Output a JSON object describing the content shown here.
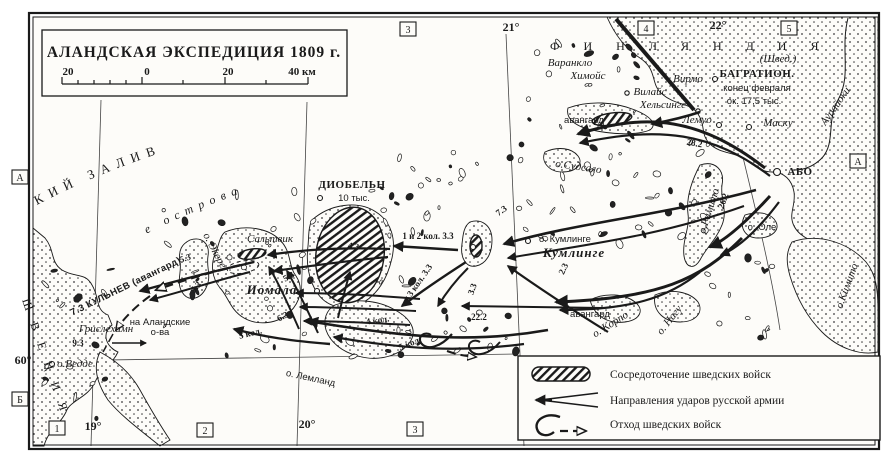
{
  "title_box": {
    "title": "АЛАНДСКАЯ ЭКСПЕДИЦИЯ 1809 г.",
    "scale_labels": [
      "20",
      "0",
      "20",
      "40 км"
    ]
  },
  "sea_labels": {
    "gulf": "БОТНИЧЕСКИЙ ЗАЛИВ",
    "aland": "Аландские острова",
    "sweden": "ШВЕЦИЯ",
    "finland": "ФИНЛЯНДИЯ",
    "finland_note": "(Швед.)"
  },
  "legend": {
    "items": [
      {
        "symbol": "swedish-concentration",
        "label": "Сосредоточение шведских войск"
      },
      {
        "symbol": "russian-strike-arrow",
        "label": "Направления ударов русской армии"
      },
      {
        "symbol": "swedish-retreat",
        "label": "Отход шведских войск"
      }
    ]
  },
  "map_labels": [
    {
      "t": "21°",
      "x": 511,
      "y": 31,
      "c": "deg"
    },
    {
      "t": "22°",
      "x": 718,
      "y": 29,
      "c": "deg"
    },
    {
      "t": "19°",
      "x": 93,
      "y": 430,
      "c": "deg"
    },
    {
      "t": "20°",
      "x": 307,
      "y": 428,
      "c": "deg"
    },
    {
      "t": "60°",
      "x": 23,
      "y": 364,
      "c": "deg"
    },
    {
      "t": "3",
      "x": 408,
      "y": 29,
      "c": "box"
    },
    {
      "t": "4",
      "x": 646,
      "y": 28,
      "c": "box"
    },
    {
      "t": "5",
      "x": 789,
      "y": 28,
      "c": "box"
    },
    {
      "t": "1",
      "x": 57,
      "y": 428,
      "c": "box"
    },
    {
      "t": "2",
      "x": 205,
      "y": 430,
      "c": "box"
    },
    {
      "t": "3",
      "x": 415,
      "y": 429,
      "c": "box"
    },
    {
      "t": "А",
      "x": 20,
      "y": 177,
      "c": "box"
    },
    {
      "t": "Б",
      "x": 20,
      "y": 399,
      "c": "box"
    },
    {
      "t": "А",
      "x": 858,
      "y": 161,
      "c": "box"
    },
    {
      "t": "Варанкло",
      "x": 570,
      "y": 66,
      "c": "it"
    },
    {
      "t": "Химойс",
      "x": 588,
      "y": 79,
      "c": "it"
    },
    {
      "t": "Вирмо",
      "x": 688,
      "y": 82,
      "c": "it"
    },
    {
      "t": "Вилайс",
      "x": 650,
      "y": 95,
      "c": "it",
      "s": 10
    },
    {
      "t": "Хельсинге",
      "x": 663,
      "y": 108,
      "c": "it",
      "s": 10
    },
    {
      "t": "Лемуо",
      "x": 697,
      "y": 123,
      "c": "it"
    },
    {
      "t": "Маску",
      "x": 778,
      "y": 126,
      "c": "it"
    },
    {
      "t": "БАГРАТИОН.",
      "x": 757,
      "y": 77,
      "c": "cap"
    },
    {
      "t": "конец февраля",
      "x": 757,
      "y": 91,
      "c": "reg",
      "s": 10.5
    },
    {
      "t": "ок. 17,5 тыс.",
      "x": 754,
      "y": 104,
      "c": "reg",
      "s": 10.5
    },
    {
      "t": "АБО",
      "x": 800,
      "y": 175,
      "c": "cap",
      "s": 12
    },
    {
      "t": "о. Оле",
      "x": 762,
      "y": 230,
      "c": "reg",
      "s": 9
    },
    {
      "t": "о.Судсало",
      "x": 578,
      "y": 170,
      "r": 8,
      "c": "it",
      "s": 10
    },
    {
      "t": "о. Кумлинге",
      "x": 565,
      "y": 242,
      "c": "reg"
    },
    {
      "t": "Кумлинге",
      "x": 574,
      "y": 257,
      "c": "bigit"
    },
    {
      "t": "ДИОБЕЛЬН",
      "x": 352,
      "y": 188,
      "c": "cap"
    },
    {
      "t": "10 тыс.",
      "x": 354,
      "y": 201,
      "c": "reg",
      "s": 10.5
    },
    {
      "t": "Сальтвик",
      "x": 270,
      "y": 242,
      "c": "it"
    },
    {
      "t": "Иомала",
      "x": 272,
      "y": 294,
      "c": "bigit",
      "s": 12
    },
    {
      "t": "о. Экере",
      "x": 212,
      "y": 252,
      "r": 62,
      "c": "it",
      "s": 9
    },
    {
      "t": "Грислехамн",
      "x": 106,
      "y": 332,
      "c": "it"
    },
    {
      "t": "9.3",
      "x": 78,
      "y": 346,
      "c": "num"
    },
    {
      "t": "на Аландские",
      "x": 160,
      "y": 325,
      "c": "reg",
      "s": 8.5
    },
    {
      "t": "о-ва",
      "x": 160,
      "y": 335,
      "c": "reg",
      "s": 8.5
    },
    {
      "t": "о.Ведде",
      "x": 75,
      "y": 367,
      "c": "it",
      "s": 10
    },
    {
      "t": "о. Лемланд",
      "x": 310,
      "y": 381,
      "r": 12,
      "c": "reg"
    },
    {
      "t": "о. Корпо",
      "x": 612,
      "y": 327,
      "r": -32,
      "c": "it",
      "s": 9.5
    },
    {
      "t": "о. Нагу",
      "x": 672,
      "y": 322,
      "r": -52,
      "c": "it",
      "s": 9.5
    },
    {
      "t": "о.Римито",
      "x": 712,
      "y": 212,
      "r": -72,
      "c": "it",
      "s": 9.5
    },
    {
      "t": "о.Кимито",
      "x": 850,
      "y": 287,
      "r": -70,
      "c": "it",
      "s": 9.5
    },
    {
      "t": "Аурайоки",
      "x": 838,
      "y": 108,
      "r": -55,
      "c": "it",
      "s": 9
    },
    {
      "t": "авангард",
      "x": 584,
      "y": 123,
      "c": "reg",
      "s": 10
    },
    {
      "t": "авангард",
      "x": 590,
      "y": 317,
      "c": "reg",
      "s": 11
    },
    {
      "t": "28.2",
      "x": 694,
      "y": 146,
      "r": 10,
      "c": "num"
    },
    {
      "t": "26.2",
      "x": 726,
      "y": 202,
      "r": -70,
      "c": "num"
    },
    {
      "t": "7.3",
      "x": 503,
      "y": 213,
      "r": -35,
      "c": "num"
    },
    {
      "t": "2.3",
      "x": 566,
      "y": 270,
      "r": -65,
      "c": "num"
    },
    {
      "t": "1 и 2 кол. 3.3",
      "x": 428,
      "y": 239,
      "c": "num",
      "s": 9.5
    },
    {
      "t": "4.3",
      "x": 353,
      "y": 249,
      "r": 10,
      "c": "num"
    },
    {
      "t": "3 кол. 3.3",
      "x": 422,
      "y": 282,
      "r": -55,
      "c": "num"
    },
    {
      "t": "3.3",
      "x": 475,
      "y": 290,
      "r": -70,
      "c": "num"
    },
    {
      "t": "22.2",
      "x": 479,
      "y": 320,
      "c": "num"
    },
    {
      "t": "4 кол.",
      "x": 378,
      "y": 323,
      "r": -8,
      "c": "num",
      "s": 10
    },
    {
      "t": "5 кол.",
      "x": 411,
      "y": 346,
      "r": -22,
      "c": "num",
      "s": 10
    },
    {
      "t": "5 кол.",
      "x": 251,
      "y": 336,
      "r": -14,
      "c": "num",
      "s": 10
    },
    {
      "t": "6.3",
      "x": 284,
      "y": 319,
      "r": -28,
      "c": "num"
    },
    {
      "t": "5.3",
      "x": 186,
      "y": 261,
      "r": -18,
      "c": "num"
    },
    {
      "t": "5.3",
      "x": 198,
      "y": 289,
      "r": -45,
      "c": "num"
    },
    {
      "t": "5.3",
      "x": 290,
      "y": 279,
      "r": -30,
      "c": "num"
    },
    {
      "t": "7.3 КУЛЬНЕВ (авангард)",
      "x": 127,
      "y": 289,
      "r": -26,
      "c": "capnum"
    }
  ],
  "colors": {
    "ink": "#1a1a1a",
    "paper": "#fdfcf9"
  }
}
